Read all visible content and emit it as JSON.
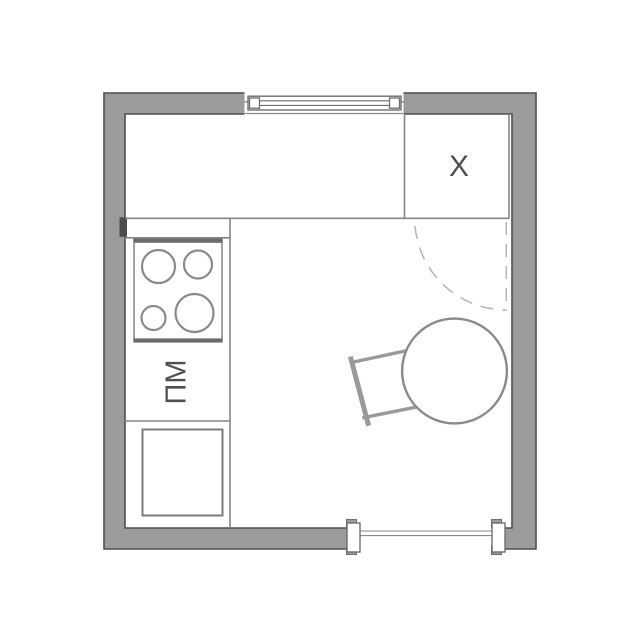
{
  "plan": {
    "name": "kitchen-floor-plan",
    "labels": {
      "fridge": "X",
      "dishwasher": "ПМ"
    },
    "colors": {
      "wall_fill": "#9b9b9b",
      "wall_outline": "#4f4f4f",
      "furniture_line": "#858585",
      "stove_edge": "#6b6b6b",
      "swing_dash": "#b5b5b5",
      "chair_line": "#9a9a9a",
      "table_line": "#8a8a8a",
      "label_text": "#4f4f4f"
    }
  }
}
